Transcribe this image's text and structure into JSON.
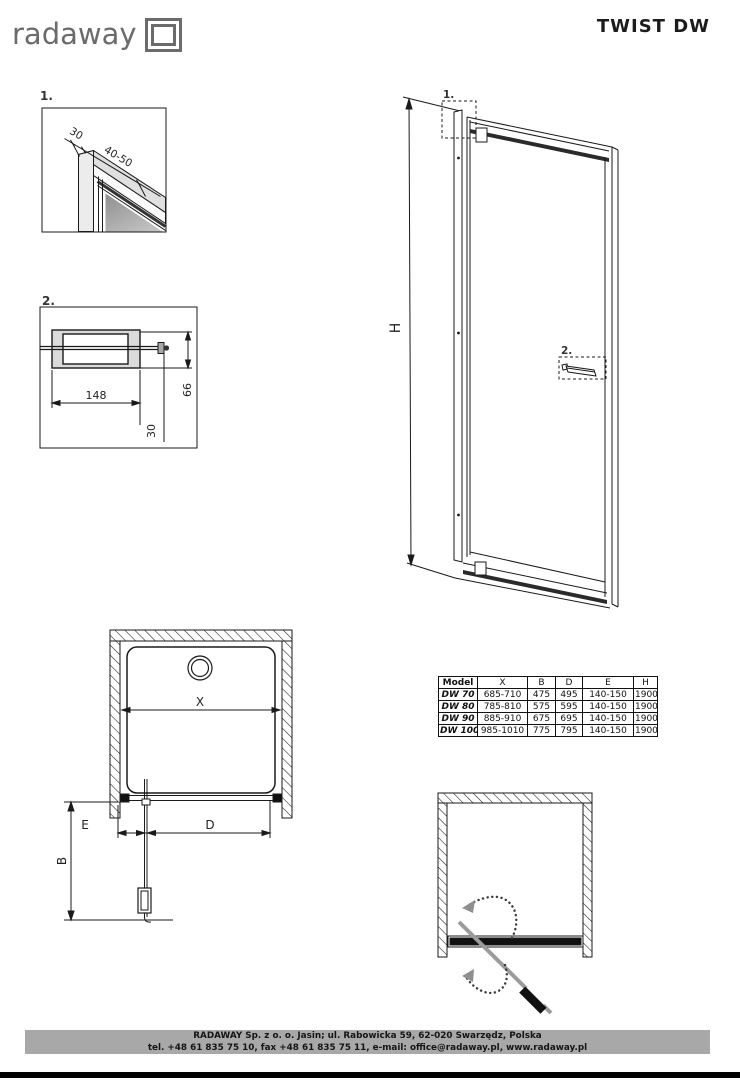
{
  "header": {
    "logo_text": "radaway",
    "title": "TWIST DW"
  },
  "detail1": {
    "label": "1.",
    "dims": {
      "profile_width": "30",
      "adjust_range": "40-50"
    }
  },
  "detail2": {
    "label": "2.",
    "dims": {
      "width": "148",
      "height": "66",
      "depth": "30"
    }
  },
  "elevation": {
    "height_label": "H",
    "marker1": "1.",
    "marker2": "2."
  },
  "plan": {
    "labels": {
      "x": "X",
      "e": "E",
      "d": "D",
      "b": "B"
    }
  },
  "table": {
    "headers": [
      "Model",
      "X",
      "B",
      "D",
      "E",
      "H"
    ],
    "rows": [
      [
        "DW 70",
        "685-710",
        "475",
        "495",
        "140-150",
        "1900"
      ],
      [
        "DW 80",
        "785-810",
        "575",
        "595",
        "140-150",
        "1900"
      ],
      [
        "DW 90",
        "885-910",
        "675",
        "695",
        "140-150",
        "1900"
      ],
      [
        "DW 100",
        "985-1010",
        "775",
        "795",
        "140-150",
        "1900"
      ]
    ]
  },
  "footer": {
    "line1": "RADAWAY Sp. z o. o. Jasin; ul. Rabowicka 59, 62-020 Swarzędz, Polska",
    "line2": "tel. +48 61 835 75 10, fax +48 61 835 75 11, e-mail: office@radaway.pl, www.radaway.pl"
  },
  "colors": {
    "line": "#1a1a1a",
    "profile_fill": "#e8e8e8",
    "swing_gray": "#9b9b9b",
    "footer_gray": "#a8a8a8"
  }
}
